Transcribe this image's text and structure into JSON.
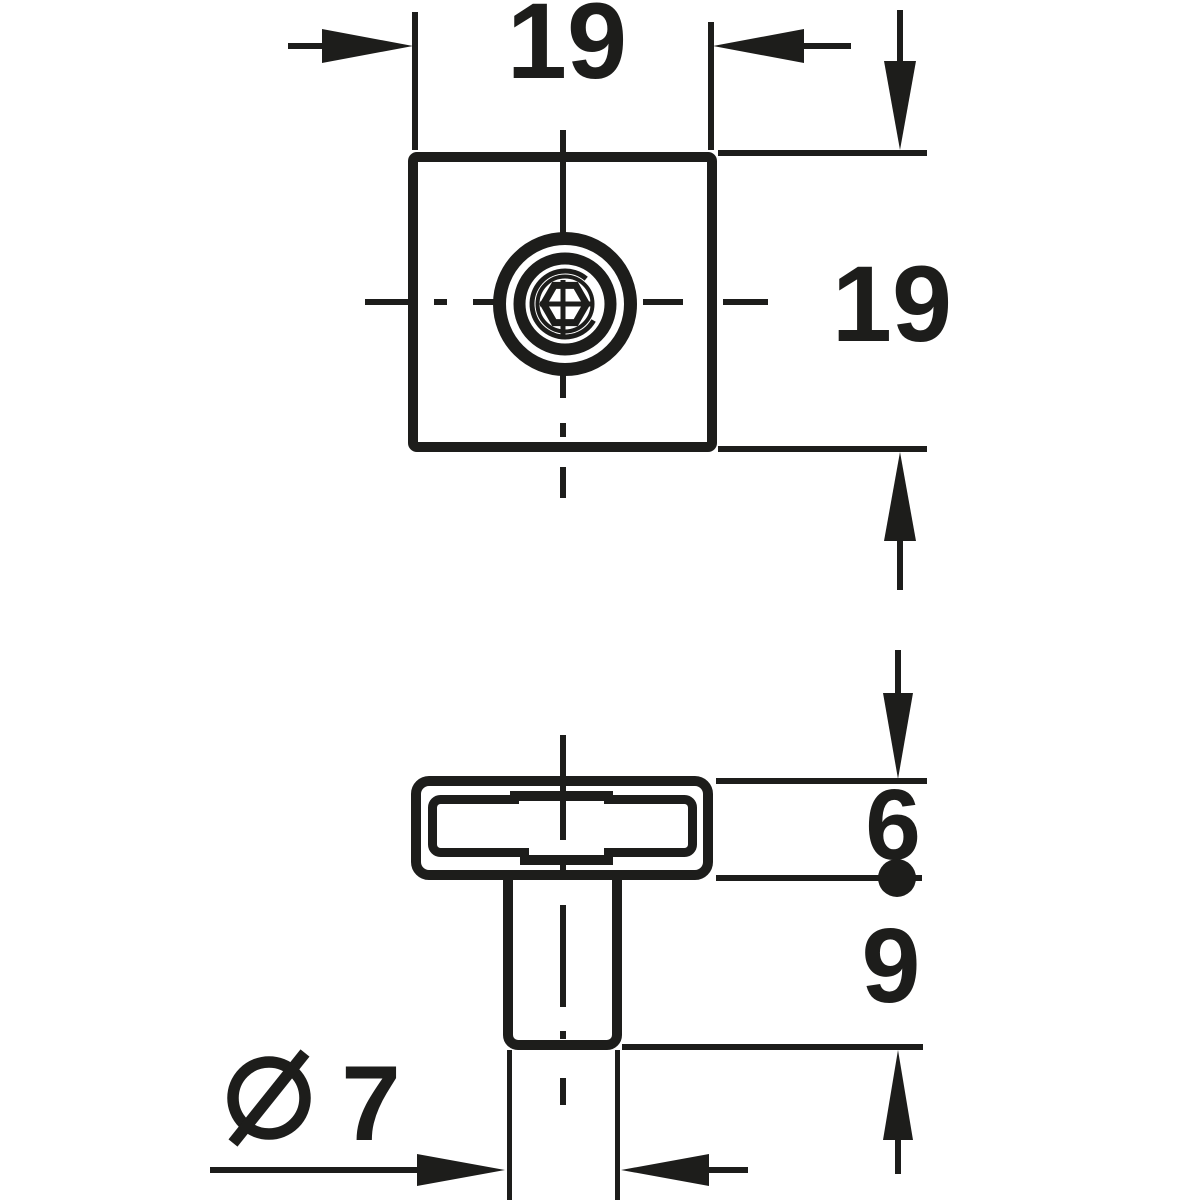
{
  "drawing": {
    "background_color": "#ffffff",
    "ink_color": "#1d1d1b",
    "dimensions": {
      "plate_width": "19",
      "plate_height": "19",
      "flange_thickness": "6",
      "stem_length": "9",
      "stem_diameter_symbol": "Ø",
      "stem_diameter_value": "7",
      "stem_diameter_label": "Ø 7"
    }
  }
}
